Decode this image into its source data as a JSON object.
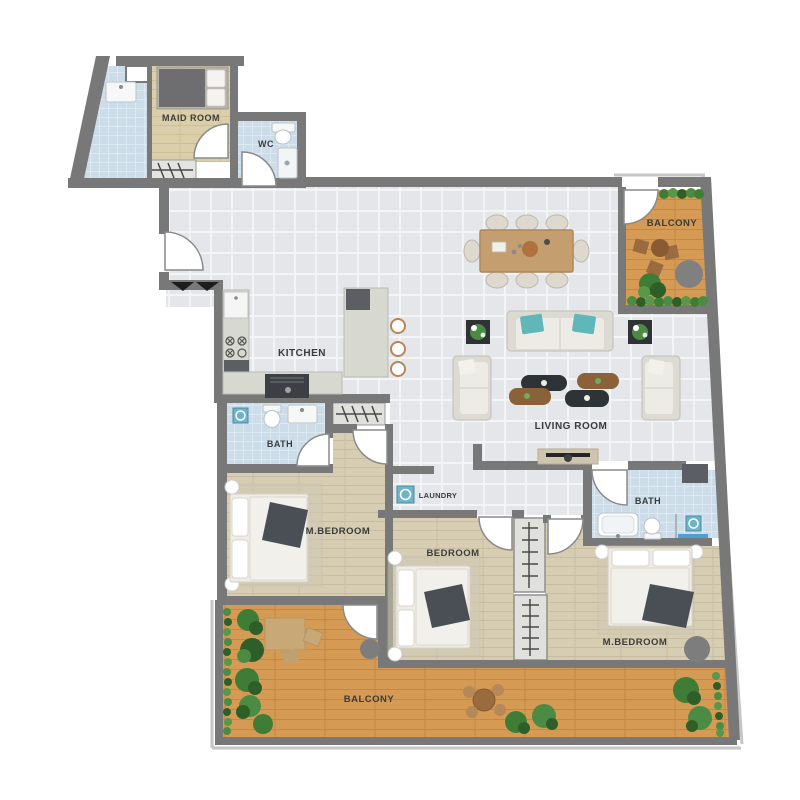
{
  "plan": {
    "rooms": {
      "maid_room": {
        "label": "MAID ROOM"
      },
      "wc": {
        "label": "WC"
      },
      "kitchen": {
        "label": "KITCHEN"
      },
      "bath_1": {
        "label": "BATH"
      },
      "living_room": {
        "label": "LIVING ROOM"
      },
      "laundry": {
        "label": "LAUNDRY"
      },
      "m_bedroom_1": {
        "label": "M.BEDROOM"
      },
      "bedroom": {
        "label": "BEDROOM"
      },
      "bath_2": {
        "label": "BATH"
      },
      "m_bedroom_2": {
        "label": "M.BEDROOM"
      },
      "balcony_1": {
        "label": "BALCONY"
      },
      "balcony_2": {
        "label": "BALCONY"
      }
    },
    "colors": {
      "wall": "#787879",
      "tile_floor": "#e5e6e9",
      "wood_floor": "#d6cdb3",
      "maid_wood_floor": "#dbcfab",
      "balcony_wood": "#d59b55",
      "bath_tile": "#ccdde9",
      "counter": "#d7d9d1",
      "sofa": "#e8e7e1",
      "accent_teal_pillow": "#5fb7ba",
      "appliance_teal": "#6db3c9",
      "plant_green": "#3f7d36",
      "plant_green_dark": "#2e5f28",
      "dark_table": "#2e3337",
      "wood_table": "#c59e70",
      "label_text": "#3b3b3b"
    }
  }
}
